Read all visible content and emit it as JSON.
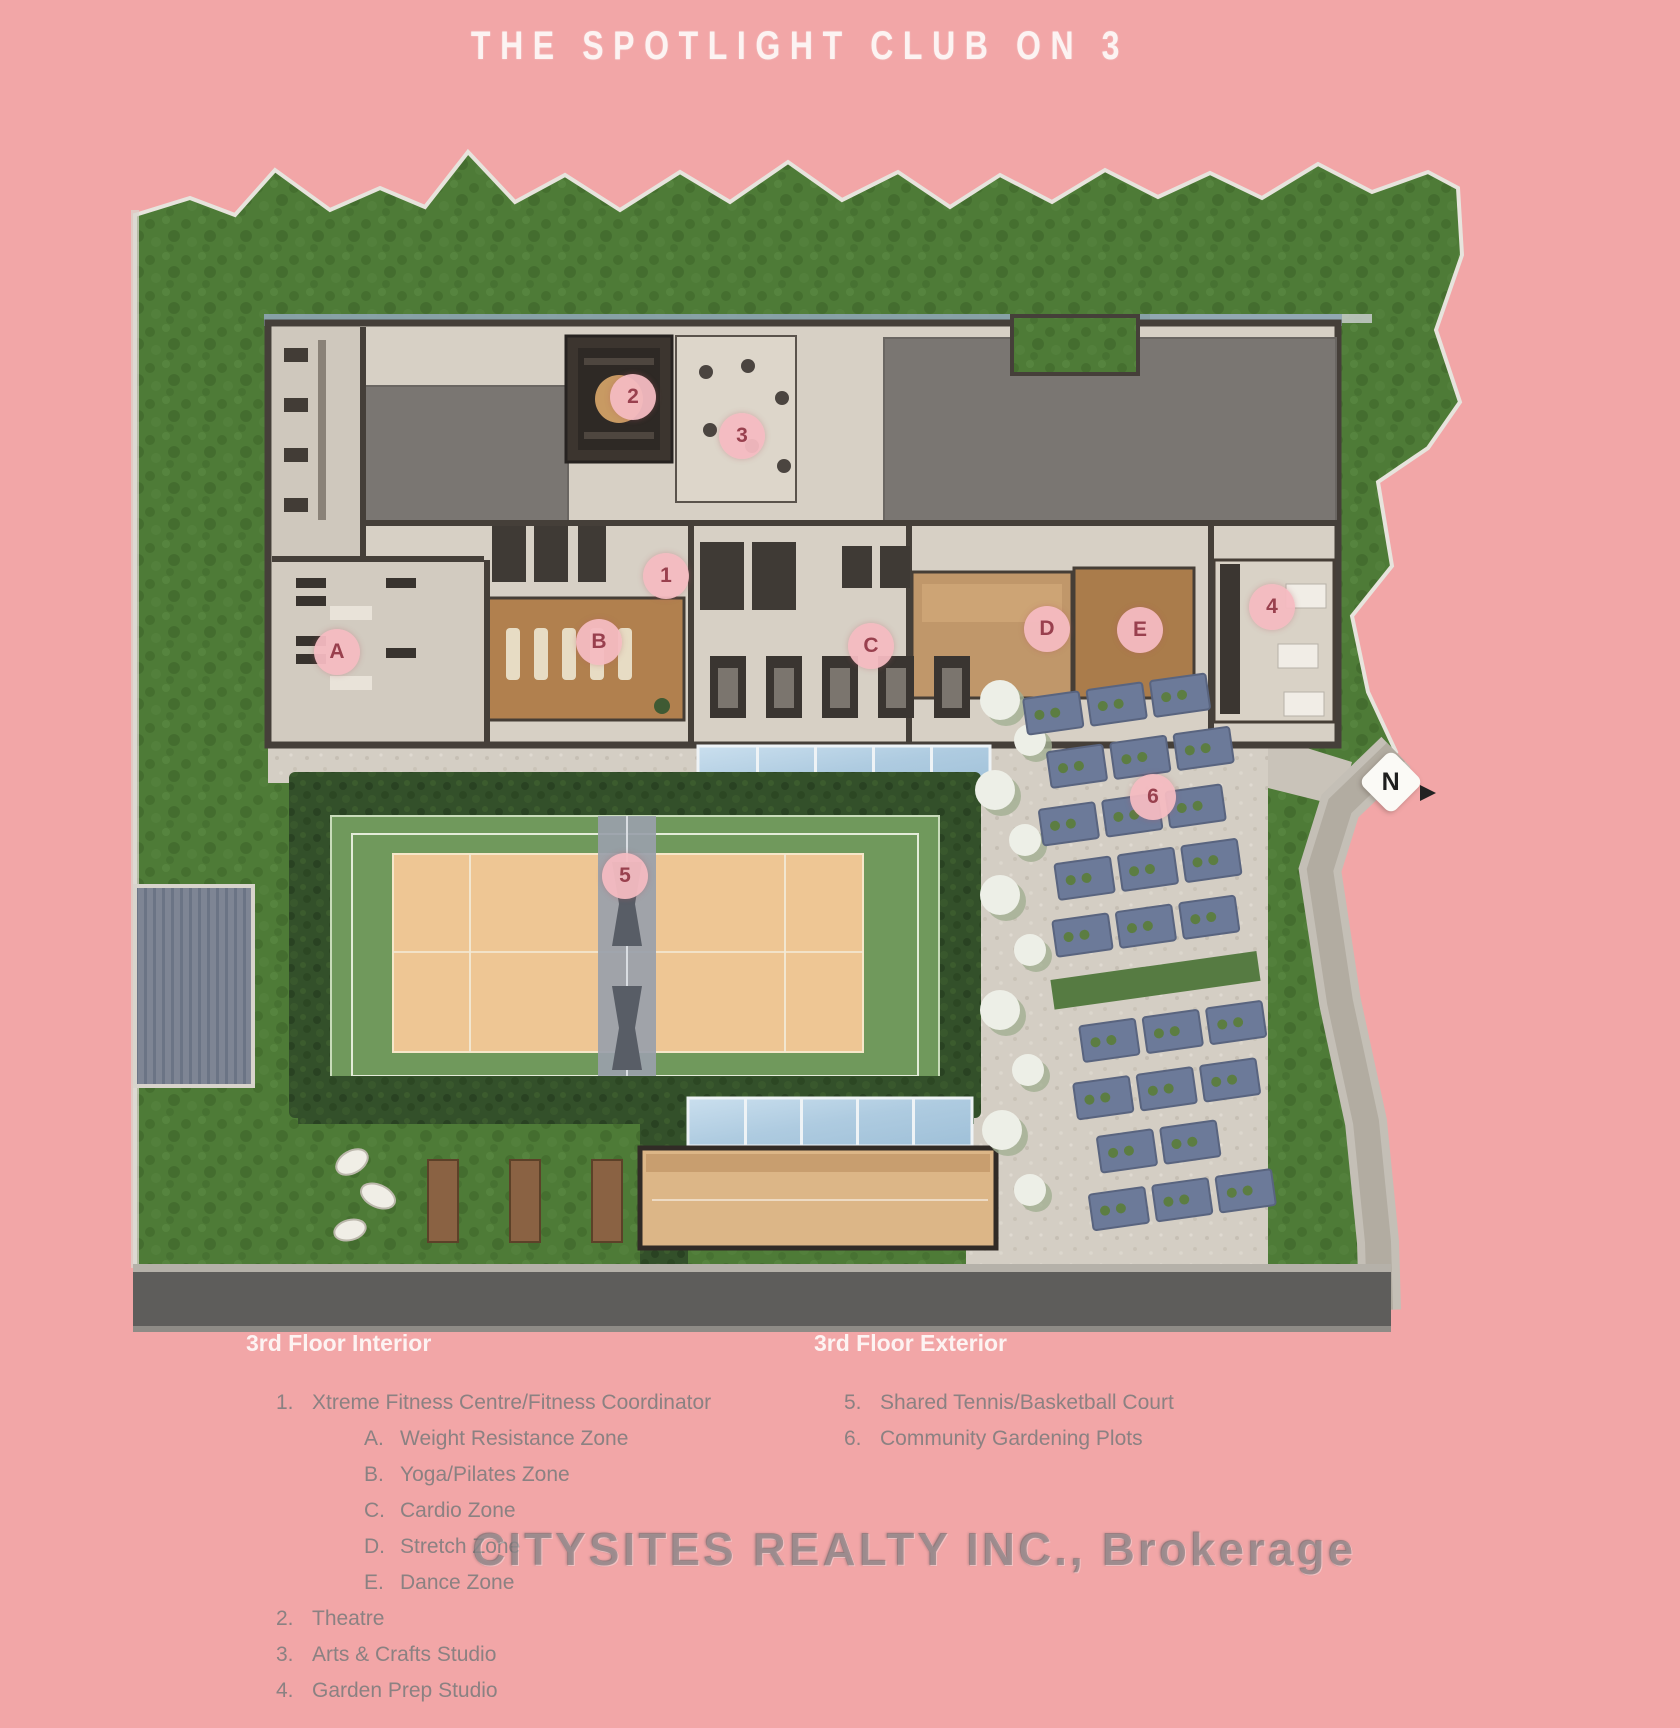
{
  "title": "THE SPOTLIGHT CLUB ON 3",
  "watermark": "CITYSITES REALTY INC., Brokerage",
  "compass": {
    "label": "N"
  },
  "colors": {
    "background_pink": "#f2a6a7",
    "marker_pink": "#f4bac2",
    "marker_text": "#99404e",
    "grass_green": "#4e7b37",
    "hedge_green": "#33502a",
    "court_green": "#70995c",
    "court_tan": "#eec694",
    "glass_blue": "#b7d2e5",
    "roof_gray": "#7a7672",
    "road_gray": "#5e5d5b"
  },
  "markers": [
    {
      "id": "A",
      "x": 337,
      "y": 652
    },
    {
      "id": "B",
      "x": 599,
      "y": 642
    },
    {
      "id": "C",
      "x": 871,
      "y": 646
    },
    {
      "id": "D",
      "x": 1047,
      "y": 629
    },
    {
      "id": "E",
      "x": 1140,
      "y": 630
    },
    {
      "id": "1",
      "x": 666,
      "y": 576
    },
    {
      "id": "2",
      "x": 633,
      "y": 397
    },
    {
      "id": "3",
      "x": 742,
      "y": 436
    },
    {
      "id": "4",
      "x": 1272,
      "y": 607
    },
    {
      "id": "5",
      "x": 625,
      "y": 876
    },
    {
      "id": "6",
      "x": 1153,
      "y": 797
    }
  ],
  "legend": {
    "interior": {
      "heading": "3rd Floor Interior",
      "items": [
        {
          "num": "1.",
          "label": "Xtreme Fitness Centre/Fitness Coordinator",
          "indent": false
        },
        {
          "num": "A.",
          "label": "Weight Resistance Zone",
          "indent": true
        },
        {
          "num": "B.",
          "label": "Yoga/Pilates Zone",
          "indent": true
        },
        {
          "num": "C.",
          "label": "Cardio Zone",
          "indent": true
        },
        {
          "num": "D.",
          "label": "Stretch Zone",
          "indent": true
        },
        {
          "num": "E.",
          "label": "Dance Zone",
          "indent": true
        },
        {
          "num": "2.",
          "label": "Theatre",
          "indent": false
        },
        {
          "num": "3.",
          "label": "Arts & Crafts Studio",
          "indent": false
        },
        {
          "num": "4.",
          "label": "Garden Prep Studio",
          "indent": false
        }
      ]
    },
    "exterior": {
      "heading": "3rd Floor Exterior",
      "items": [
        {
          "num": "5.",
          "label": "Shared Tennis/Basketball Court",
          "indent": false
        },
        {
          "num": "6.",
          "label": "Community Gardening Plots",
          "indent": false
        }
      ]
    }
  }
}
